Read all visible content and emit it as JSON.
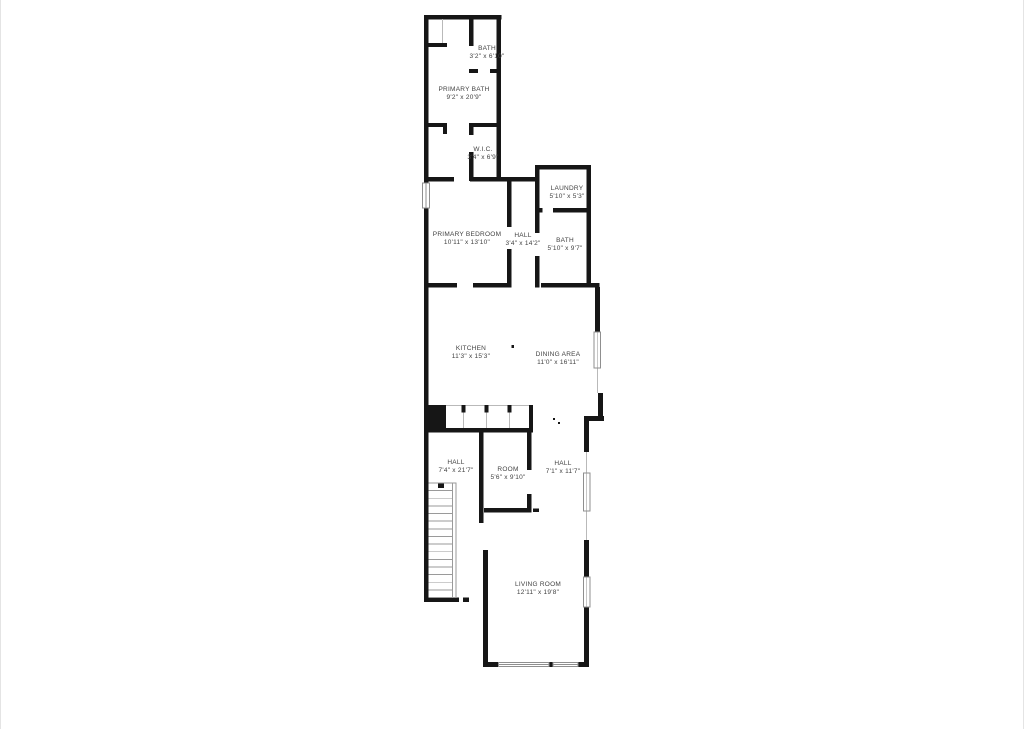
{
  "page": {
    "background": "#ffffff",
    "edge_line_color": "#e4e4e4"
  },
  "floorplan": {
    "wall_color": "#161616",
    "label_color": "#424242",
    "rooms": [
      {
        "id": "bath-upper",
        "name": "BATH",
        "dims": "3'2\" x 6'10\"",
        "cx": 486,
        "cy": 53
      },
      {
        "id": "primary-bath",
        "name": "PRIMARY BATH",
        "dims": "9'2\" x 20'9\"",
        "cx": 463,
        "cy": 94
      },
      {
        "id": "wic",
        "name": "W.I.C.",
        "dims": "3'4\" x 6'9\"",
        "cx": 482,
        "cy": 154
      },
      {
        "id": "laundry",
        "name": "LAUNDRY",
        "dims": "5'10\" x 5'3\"",
        "cx": 566,
        "cy": 193
      },
      {
        "id": "primary-bedroom",
        "name": "PRIMARY BEDROOM",
        "dims": "10'11\" x 13'10\"",
        "cx": 466,
        "cy": 239
      },
      {
        "id": "hall-upper",
        "name": "HALL",
        "dims": "3'4\" x 14'2\"",
        "cx": 522,
        "cy": 240
      },
      {
        "id": "bath-middle",
        "name": "BATH",
        "dims": "5'10\" x 9'7\"",
        "cx": 564,
        "cy": 245
      },
      {
        "id": "kitchen",
        "name": "KITCHEN",
        "dims": "11'3\" x 15'3\"",
        "cx": 470,
        "cy": 353
      },
      {
        "id": "dining-area",
        "name": "DINING AREA",
        "dims": "11'0\" x 16'11\"",
        "cx": 557,
        "cy": 359
      },
      {
        "id": "hall-lower-left",
        "name": "HALL",
        "dims": "7'4\" x 21'7\"",
        "cx": 455,
        "cy": 467
      },
      {
        "id": "room",
        "name": "ROOM",
        "dims": "5'6\" x 9'10\"",
        "cx": 507,
        "cy": 474
      },
      {
        "id": "hall-lower-right",
        "name": "HALL",
        "dims": "7'1\" x 11'7\"",
        "cx": 562,
        "cy": 468
      },
      {
        "id": "living-room",
        "name": "LIVING ROOM",
        "dims": "12'11\" x 19'8\"",
        "cx": 537,
        "cy": 589
      }
    ],
    "stairs": {
      "x": 427.5,
      "y": 483,
      "width": 24,
      "height": 114.5,
      "treads": 15
    }
  }
}
